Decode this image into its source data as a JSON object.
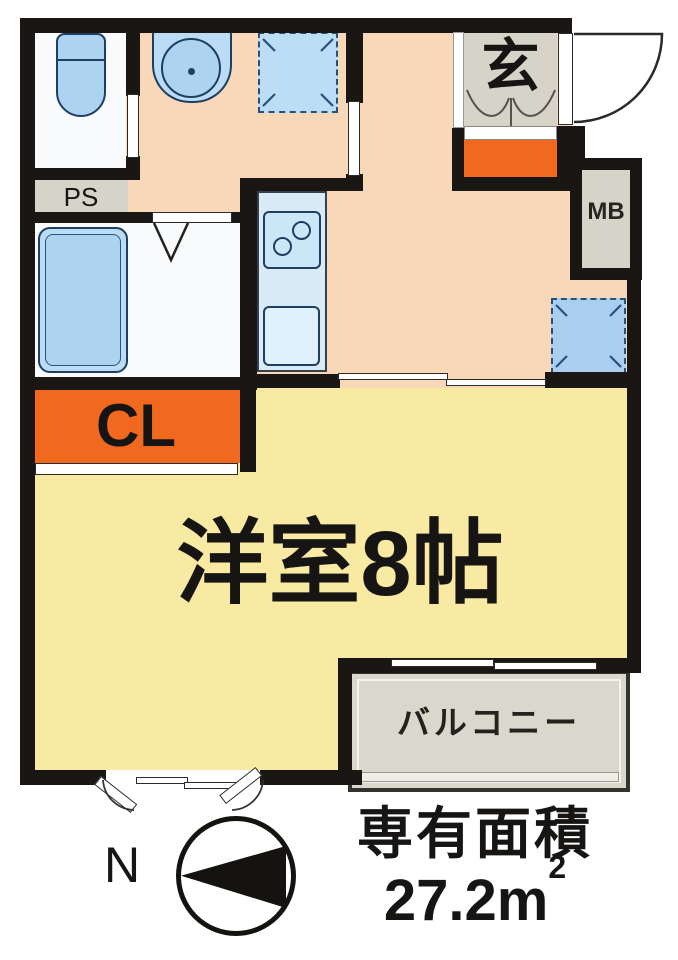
{
  "labels": {
    "entrance": "玄",
    "pipe_space": "PS",
    "meter_box": "MB",
    "closet": "CL",
    "main_room": "洋室8帖",
    "balcony": "バルコニー",
    "compass_north": "N",
    "area_title": "専有面積",
    "area_value": "27.2m",
    "area_unit_sup": "2"
  },
  "fixtures": [
    "toilet",
    "bathtub",
    "washbasin",
    "washing-machine-space",
    "kitchen-stove",
    "kitchen-sink",
    "refrigerator-space",
    "entrance-door-swing",
    "bay-window",
    "north-compass"
  ],
  "colors": {
    "wall": "#1a1613",
    "hall_floor": "#f8d8b8",
    "main_room_floor": "#f8e9a3",
    "accent_orange": "#f1681f",
    "fixture_blue": "#aed3f0",
    "fixture_outline": "#1e3f63",
    "service_gray": "#d6d4c9",
    "balcony_gray": "#d9d8cc",
    "background": "#ffffff"
  }
}
